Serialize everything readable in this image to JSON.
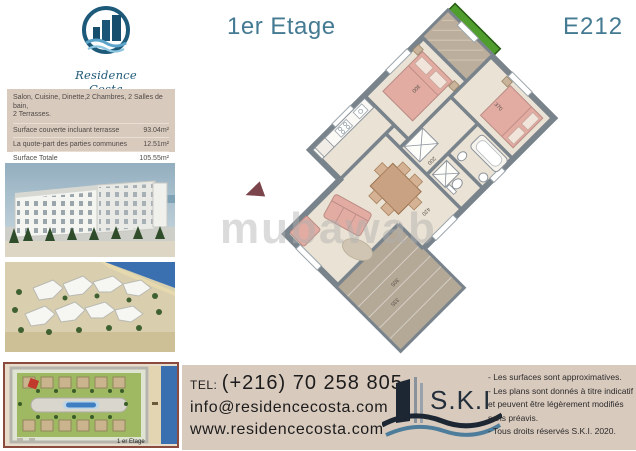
{
  "header": {
    "title": "1er Etage",
    "unit": "E212"
  },
  "brand": {
    "name": "Residence Costa"
  },
  "info_box": {
    "description_line1": "Salon, Cuisine, Dinette,2 Chambres, 2 Salles de bain,",
    "description_line2": "2 Terrasses.",
    "rows": [
      {
        "label": "Surface couverte incluant terrasse",
        "value": "93.04m²"
      },
      {
        "label": "La quote-part des parties communes",
        "value": "12.51m²"
      },
      {
        "label": "Surface Totale",
        "value": "105.55m²"
      }
    ]
  },
  "plan": {
    "dimensions": [
      "370",
      "300",
      "200",
      "420",
      "305",
      "335"
    ]
  },
  "watermark": "mubawab",
  "site_plan": {
    "floor_label": "1 er Etage"
  },
  "contact": {
    "tel_label": "TEL:",
    "phone": "(+216) 70 258 805",
    "email": "info@residencecosta.com",
    "website": "www.residencecosta.com"
  },
  "ski": {
    "name": "S.K.I",
    "notes": [
      "- Les surfaces sont approximatives.",
      "- Les plans sont donnés à titre indicatif",
      "et peuvent être légèrement modifiés",
      "sans préavis.",
      "- Tous droits réservés S.K.I. 2020."
    ]
  }
}
